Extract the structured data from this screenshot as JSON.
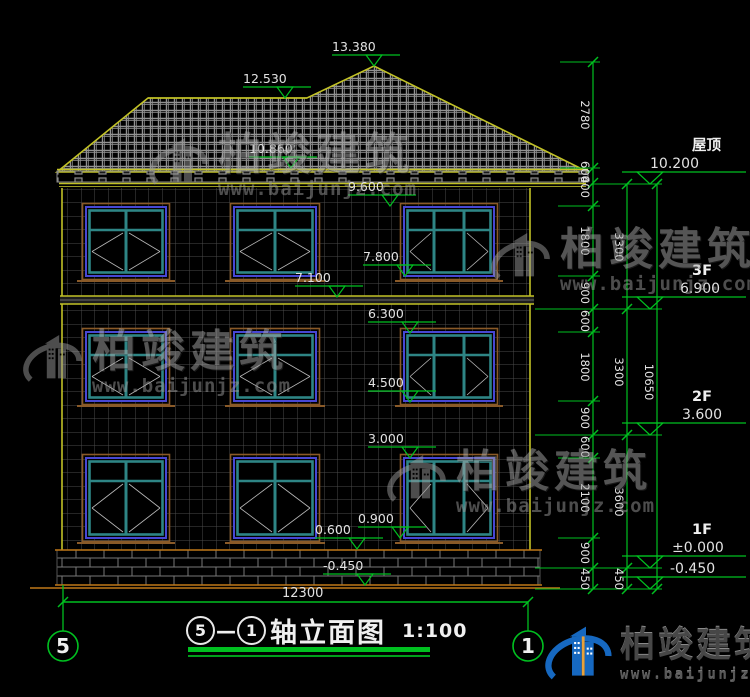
{
  "colors": {
    "bg": "#000000",
    "green": "#00c020",
    "dim_text": "#e2e2e2",
    "yellow": "#c2c226",
    "orange": "#c07818",
    "wall_grid": "#4a4a4a",
    "roof_grid": "#929292",
    "fascia": "#8a8a8a",
    "window_blue": "#4747d4",
    "window_teal": "#2e8585",
    "window_trim": "#8a5a28",
    "pane_line": "#b8b8b8",
    "white_text": "#f0f0f0",
    "logo_blue": "#1668c0"
  },
  "title_block": {
    "axis_start": "5",
    "separator": "—",
    "axis_end": "1",
    "name": "轴立面图",
    "scale": "1:100"
  },
  "axis_bubbles": [
    {
      "n": "5",
      "cx": 63,
      "cy": 646,
      "line_y1": 585,
      "line_y2": 631
    },
    {
      "n": "1",
      "cx": 528,
      "cy": 646,
      "line_y1": 602,
      "line_y2": 631
    }
  ],
  "bottom_dim": {
    "label": "12300",
    "y": 602,
    "x1": 63,
    "x2": 528,
    "label_x": 282,
    "label_y": 597
  },
  "facade_markers": [
    {
      "label": "13.380",
      "ax": 374,
      "ay": 66
    },
    {
      "label": "12.530",
      "ax": 285,
      "ay": 98
    },
    {
      "label": "10.860",
      "ax": 291,
      "ay": 168
    },
    {
      "label": "9.600",
      "ax": 390,
      "ay": 206
    },
    {
      "label": "7.800",
      "ax": 405,
      "ay": 276
    },
    {
      "label": "7.100",
      "ax": 337,
      "ay": 297
    },
    {
      "label": "6.300",
      "ax": 410,
      "ay": 333
    },
    {
      "label": "4.500",
      "ax": 410,
      "ay": 402
    },
    {
      "label": "3.000",
      "ax": 410,
      "ay": 458
    },
    {
      "label": "0.900",
      "ax": 400,
      "ay": 538
    },
    {
      "label": "0.600",
      "ax": 357,
      "ay": 549
    },
    {
      "label": "-0.450",
      "ax": 365,
      "ay": 585
    }
  ],
  "right_levels": [
    {
      "floor": "屋顶",
      "value": "10.200",
      "ay": 184,
      "vx": 650
    },
    {
      "floor": "3F",
      "value": "6.900",
      "ay": 309,
      "vx": 680
    },
    {
      "floor": "2F",
      "value": "3.600",
      "ay": 435,
      "vx": 682
    },
    {
      "floor": "1F",
      "value": "±0.000",
      "ay": 568,
      "vx": 672
    },
    {
      "floor": "",
      "value": "-0.450",
      "ay": 589,
      "vx": 670
    }
  ],
  "dim_chains": [
    {
      "x": 593,
      "label_x": 581,
      "ticks": [
        62,
        168,
        183,
        206,
        276,
        309,
        332,
        401,
        435,
        458,
        538,
        568,
        589
      ],
      "segments": [
        {
          "t": "2780",
          "y": 115
        },
        {
          "t": "600",
          "y": 172
        },
        {
          "t": "400",
          "y": 187
        },
        {
          "t": "1800",
          "y": 241
        },
        {
          "t": "900",
          "y": 293
        },
        {
          "t": "600",
          "y": 321
        },
        {
          "t": "1800",
          "y": 367
        },
        {
          "t": "900",
          "y": 418
        },
        {
          "t": "600",
          "y": 447
        },
        {
          "t": "2100",
          "y": 498
        },
        {
          "t": "900",
          "y": 553
        },
        {
          "t": "450",
          "y": 579
        }
      ]
    },
    {
      "x": 627,
      "label_x": 615,
      "ticks": [
        184,
        309,
        435,
        568,
        589
      ],
      "segments": [
        {
          "t": "3300",
          "y": 247
        },
        {
          "t": "3300",
          "y": 372
        },
        {
          "t": "3600",
          "y": 502
        },
        {
          "t": "450",
          "y": 579
        }
      ]
    },
    {
      "x": 657,
      "label_x": 645,
      "ticks": [
        184,
        589
      ],
      "segments": [
        {
          "t": "10650",
          "y": 382
        }
      ]
    }
  ],
  "extensions": [
    {
      "y": 62,
      "x1": 560,
      "x2": 600
    },
    {
      "y": 168,
      "x1": 560,
      "x2": 600
    },
    {
      "y": 184,
      "x1": 593,
      "x2": 662
    },
    {
      "y": 206,
      "x1": 558,
      "x2": 600
    },
    {
      "y": 276,
      "x1": 558,
      "x2": 600
    },
    {
      "y": 309,
      "x1": 535,
      "x2": 662
    },
    {
      "y": 332,
      "x1": 558,
      "x2": 600
    },
    {
      "y": 401,
      "x1": 558,
      "x2": 600
    },
    {
      "y": 435,
      "x1": 535,
      "x2": 662
    },
    {
      "y": 458,
      "x1": 558,
      "x2": 600
    },
    {
      "y": 538,
      "x1": 558,
      "x2": 600
    },
    {
      "y": 568,
      "x1": 535,
      "x2": 662
    },
    {
      "y": 589,
      "x1": 535,
      "x2": 662
    }
  ],
  "windows": {
    "rows": [
      {
        "y": 207,
        "h": 69,
        "t": 23
      },
      {
        "y": 332,
        "h": 69,
        "t": 23
      },
      {
        "y": 458,
        "h": 80,
        "t": 23
      }
    ],
    "cols": [
      {
        "x": 86,
        "w": 80,
        "p": 2
      },
      {
        "x": 234,
        "w": 82,
        "p": 2
      },
      {
        "x": 404,
        "w": 90,
        "p": 3
      }
    ]
  },
  "watermark": {
    "brand": "柏竣建筑",
    "url": "www.baijunjz.com",
    "instances": [
      {
        "x": 148,
        "y": 133
      },
      {
        "x": 490,
        "y": 228
      },
      {
        "x": 22,
        "y": 330
      },
      {
        "x": 386,
        "y": 450
      }
    ]
  },
  "footer_logo": {
    "brand": "柏竣建筑",
    "url": "www.baijunjz.com"
  }
}
